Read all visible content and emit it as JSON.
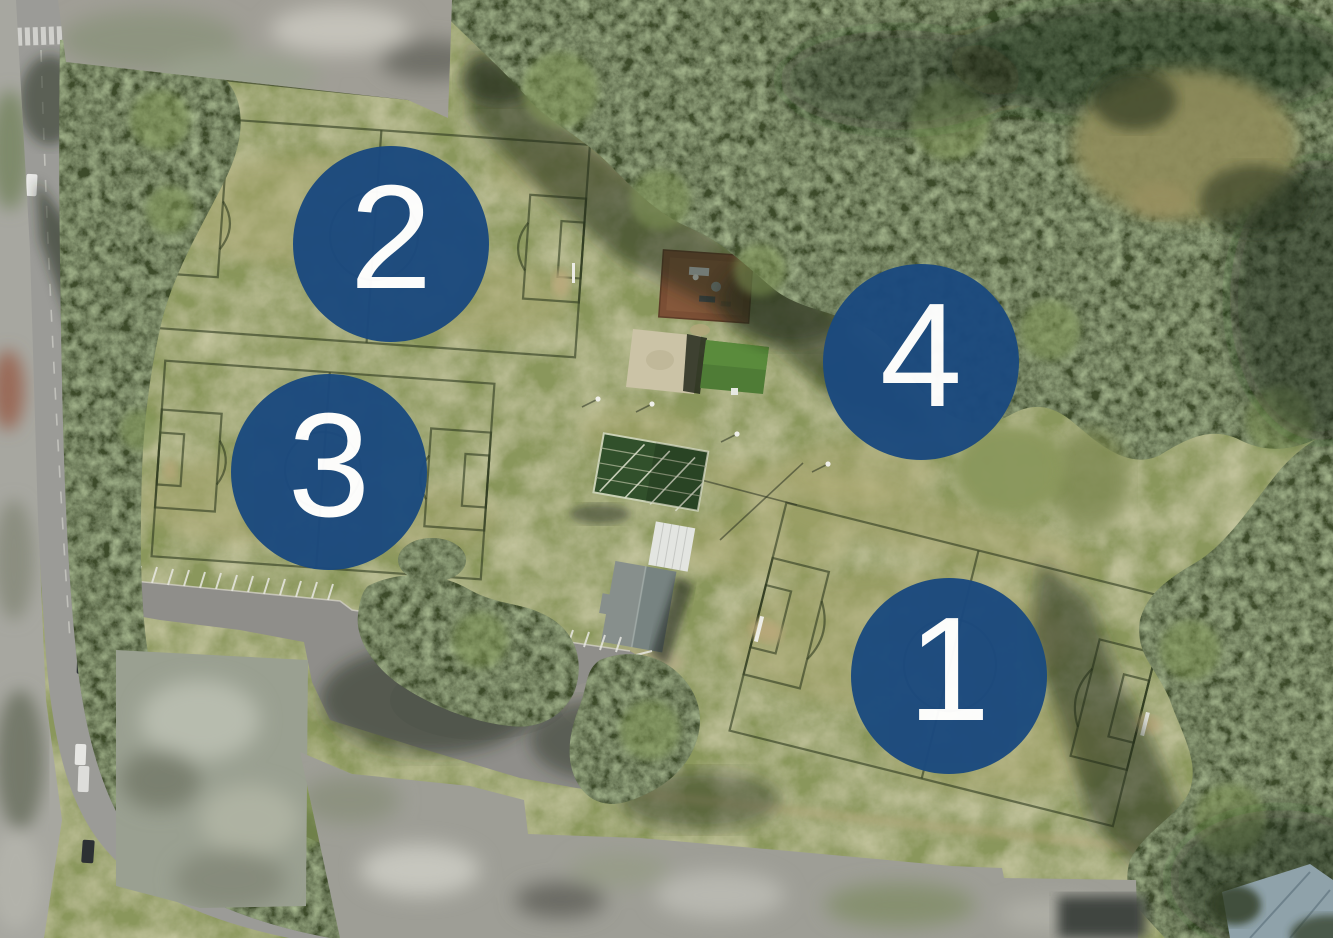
{
  "map": {
    "title": "sports-ground-aerial-map",
    "markers": [
      {
        "label": "1",
        "x": 949,
        "y": 676
      },
      {
        "label": "2",
        "x": 391,
        "y": 244
      },
      {
        "label": "3",
        "x": 329,
        "y": 472
      },
      {
        "label": "4",
        "x": 921,
        "y": 362
      }
    ],
    "marker_style": {
      "diameter": 196,
      "fill": "#1B4A7E",
      "text_color": "#FFFFFF",
      "opacity": 0.97
    },
    "palette": {
      "grass": "#8A975B",
      "grass_dry": "#A7A56D",
      "canopy": "#3D4C2B",
      "shadow": "#1C2616",
      "road": "#9B9B97",
      "asphalt": "#8F8E8A",
      "blur_gray": "#A09E96",
      "concrete": "#CBC3A6",
      "cricket_pitch": "#4F7C36",
      "playground": "#7B4F35",
      "roof_gray": "#878F8C",
      "roof_white": "#E3E5E1"
    }
  }
}
